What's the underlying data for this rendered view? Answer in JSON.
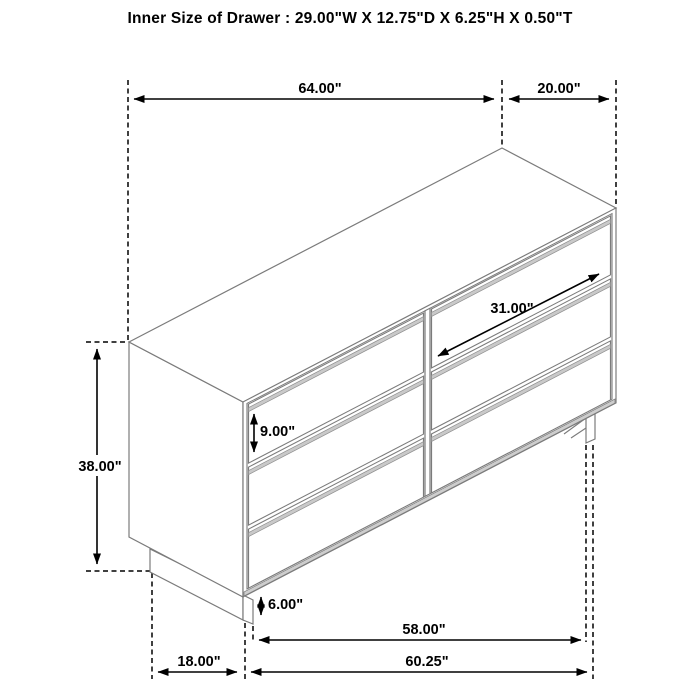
{
  "title": "Inner Size of Drawer : 29.00\"W X 12.75\"D X 6.25\"H X 0.50\"T",
  "diagram": {
    "kind": "isometric-furniture-dimension-drawing",
    "item": "six-drawer dresser",
    "colors": {
      "background": "#ffffff",
      "furniture_line": "#7b7b7b",
      "dimension_line": "#000000",
      "handle_groove_fill": "#c9c9c9"
    },
    "dims": {
      "top_width": {
        "label": "64.00\""
      },
      "top_depth": {
        "label": "20.00\""
      },
      "height": {
        "label": "38.00\""
      },
      "drawer_width": {
        "label": "31.00\""
      },
      "drawer_height": {
        "label": "9.00\""
      },
      "leg_height": {
        "label": "6.00\""
      },
      "base_width": {
        "label": "58.00\""
      },
      "base_depth": {
        "label": "18.00\""
      },
      "bottom_width": {
        "label": "60.25\""
      }
    }
  }
}
